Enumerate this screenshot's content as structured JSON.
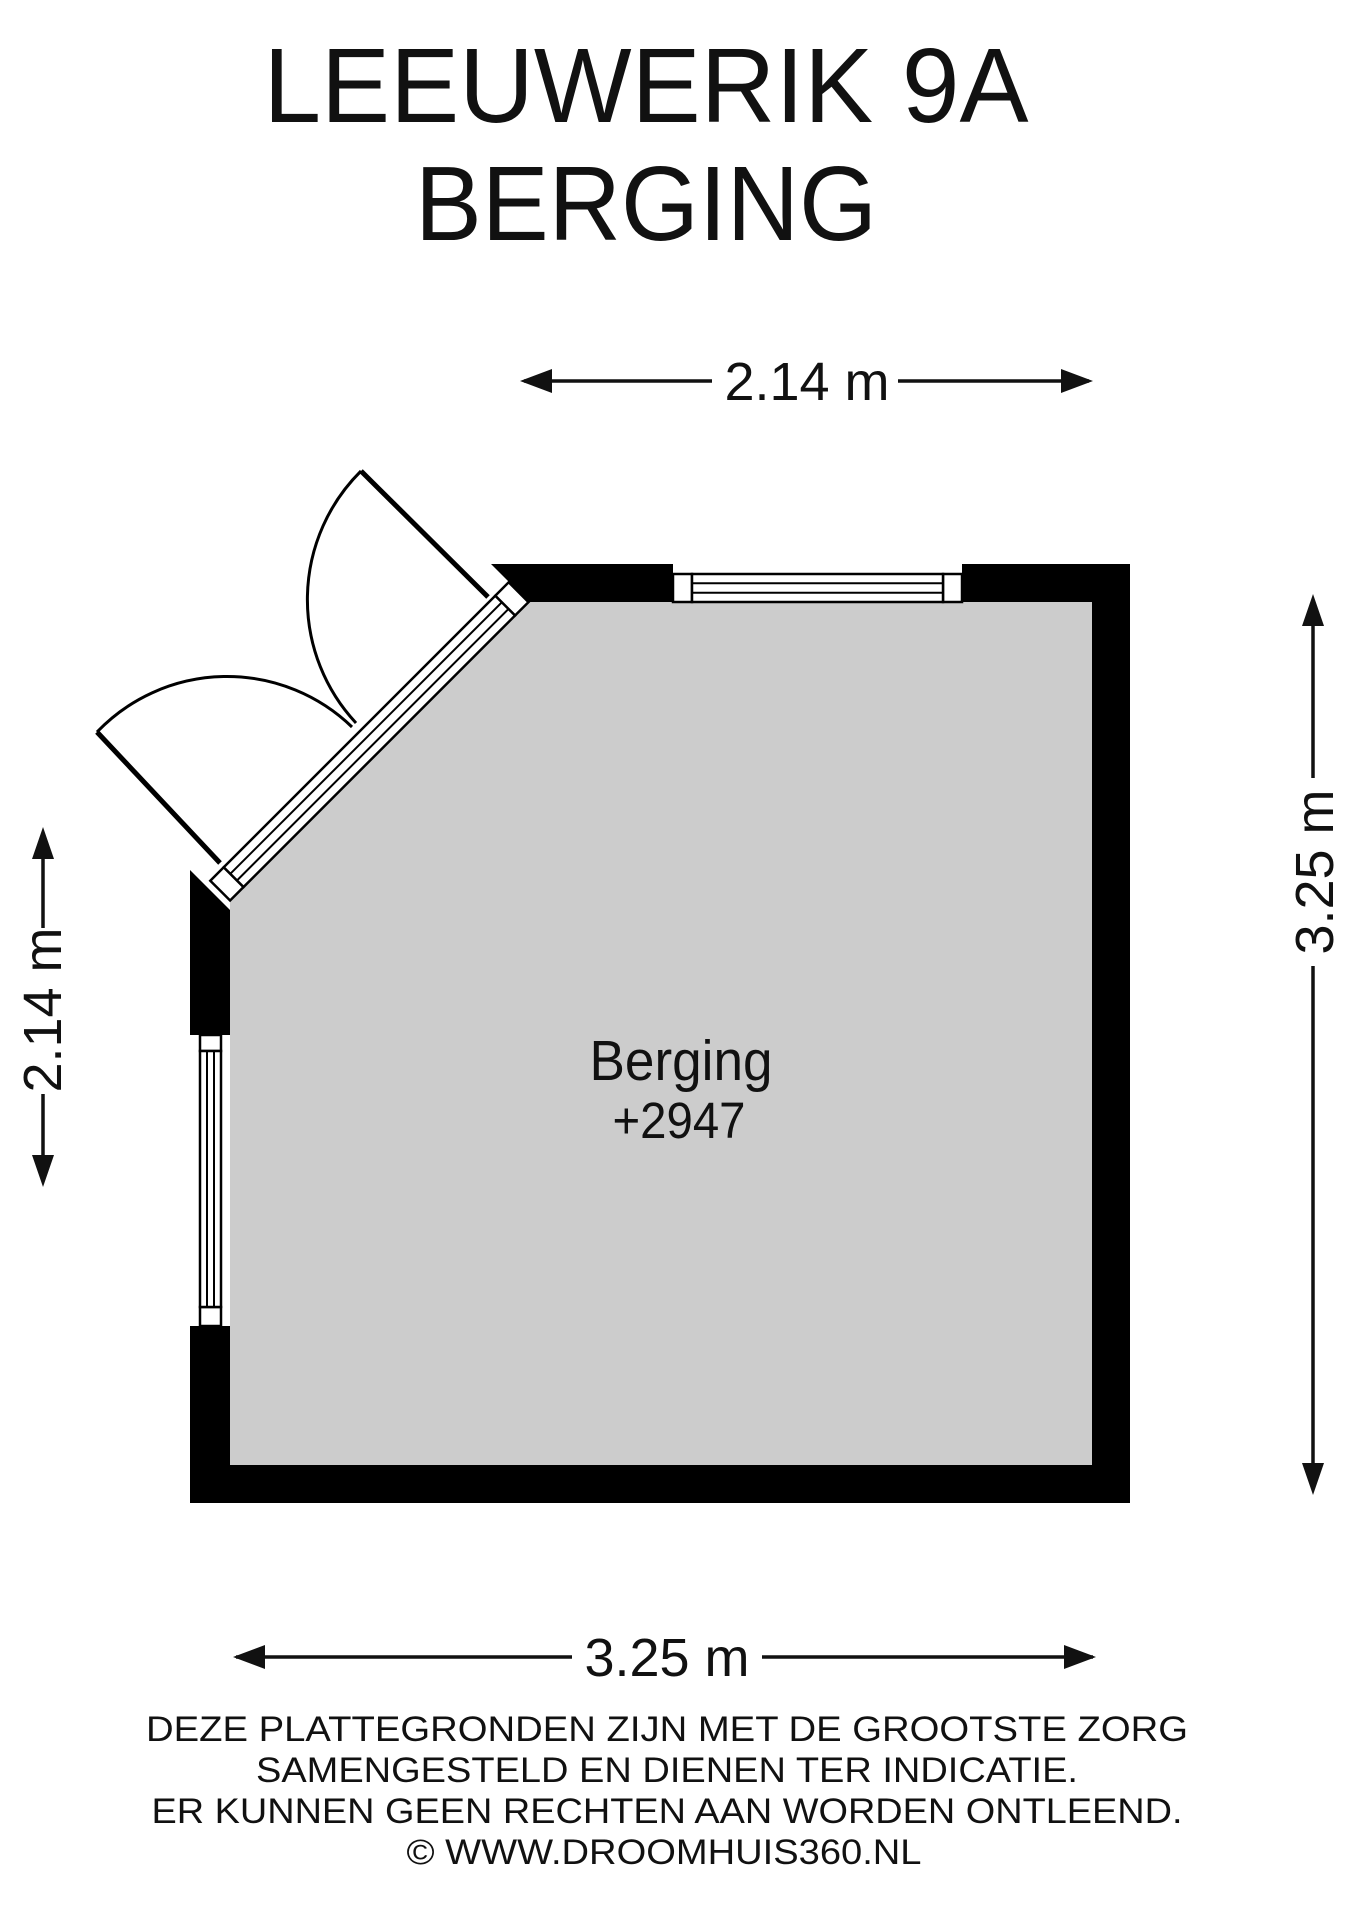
{
  "title": {
    "line1": "LEEUWERIK 9A",
    "line2": "BERGING"
  },
  "room": {
    "name": "Berging",
    "level": "+2947"
  },
  "dimensions": {
    "top": "2.14 m",
    "bottom": "3.25 m",
    "left": "2.14 m",
    "right": "3.25 m"
  },
  "disclaimer": {
    "line1": "DEZE PLATTEGRONDEN ZIJN MET DE GROOTSTE ZORG",
    "line2": "SAMENGESTELD EN DIENEN TER INDICATIE.",
    "line3": "ER KUNNEN GEEN RECHTEN AAN WORDEN ONTLEEND.",
    "line4": "© WWW.DROOMHUIS360.NL"
  },
  "colors": {
    "wall": "#000000",
    "floor": "#cccccc",
    "ink": "#111111",
    "background": "#ffffff"
  }
}
